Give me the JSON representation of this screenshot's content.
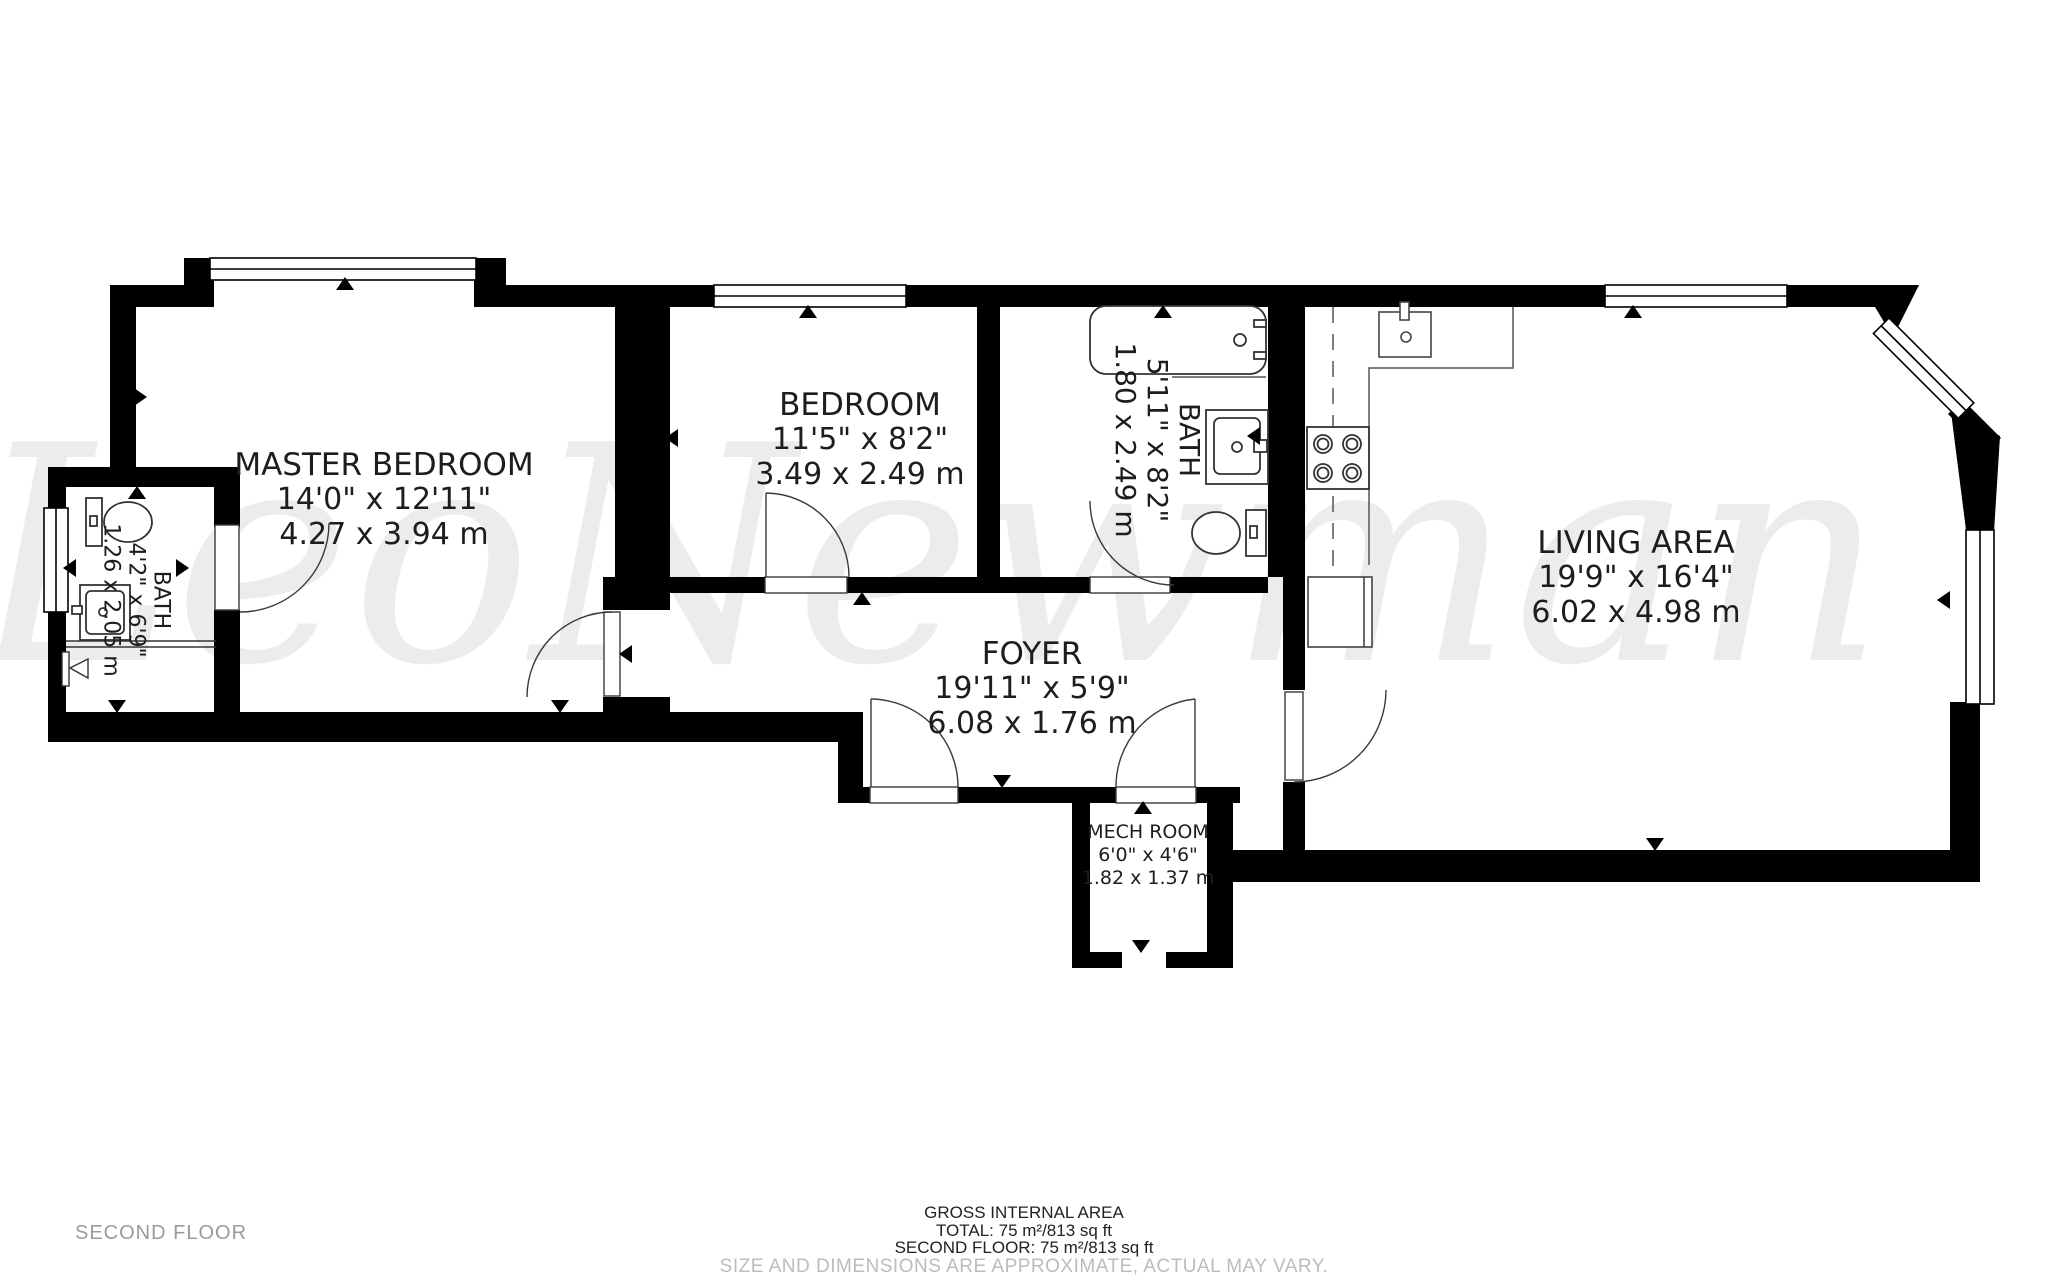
{
  "floor_plan": {
    "floor_label": "SECOND FLOOR",
    "watermark": "LeoNewman",
    "rooms": [
      {
        "id": "master-bedroom",
        "name": "MASTER BEDROOM",
        "imperial": "14'0\" x 12'11\"",
        "metric": "4.27 x 3.94 m"
      },
      {
        "id": "bedroom",
        "name": "BEDROOM",
        "imperial": "11'5\" x 8'2\"",
        "metric": "3.49 x 2.49 m"
      },
      {
        "id": "bath",
        "name": "BATH",
        "imperial": "5'11\" x 8'2\"",
        "metric": "1.80 x 2.49 m"
      },
      {
        "id": "bath-2",
        "name": "BATH",
        "imperial": "4'2\" x 6'9\"",
        "metric": "1.26 x 2.05 m"
      },
      {
        "id": "living-area",
        "name": "LIVING AREA",
        "imperial": "19'9\" x 16'4\"",
        "metric": "6.02 x 4.98 m"
      },
      {
        "id": "foyer",
        "name": "FOYER",
        "imperial": "19'11\" x 5'9\"",
        "metric": "6.08 x 1.76 m"
      },
      {
        "id": "mech-room",
        "name": "MECH ROOM",
        "imperial": "6'0\" x 4'6\"",
        "metric": "1.82 x 1.37 m"
      }
    ],
    "summary": {
      "title": "GROSS INTERNAL AREA",
      "total": "TOTAL: 75 m²/813 sq ft",
      "floor_total": "SECOND FLOOR: 75 m²/813 sq ft",
      "disclaimer": "SIZE AND DIMENSIONS ARE APPROXIMATE, ACTUAL MAY VARY."
    },
    "colors": {
      "wall": "#000000",
      "label": "#1d1d1d",
      "muted": "#9b9b9b",
      "disclaimer": "#bcbcbc",
      "watermark": "#ececec"
    }
  }
}
